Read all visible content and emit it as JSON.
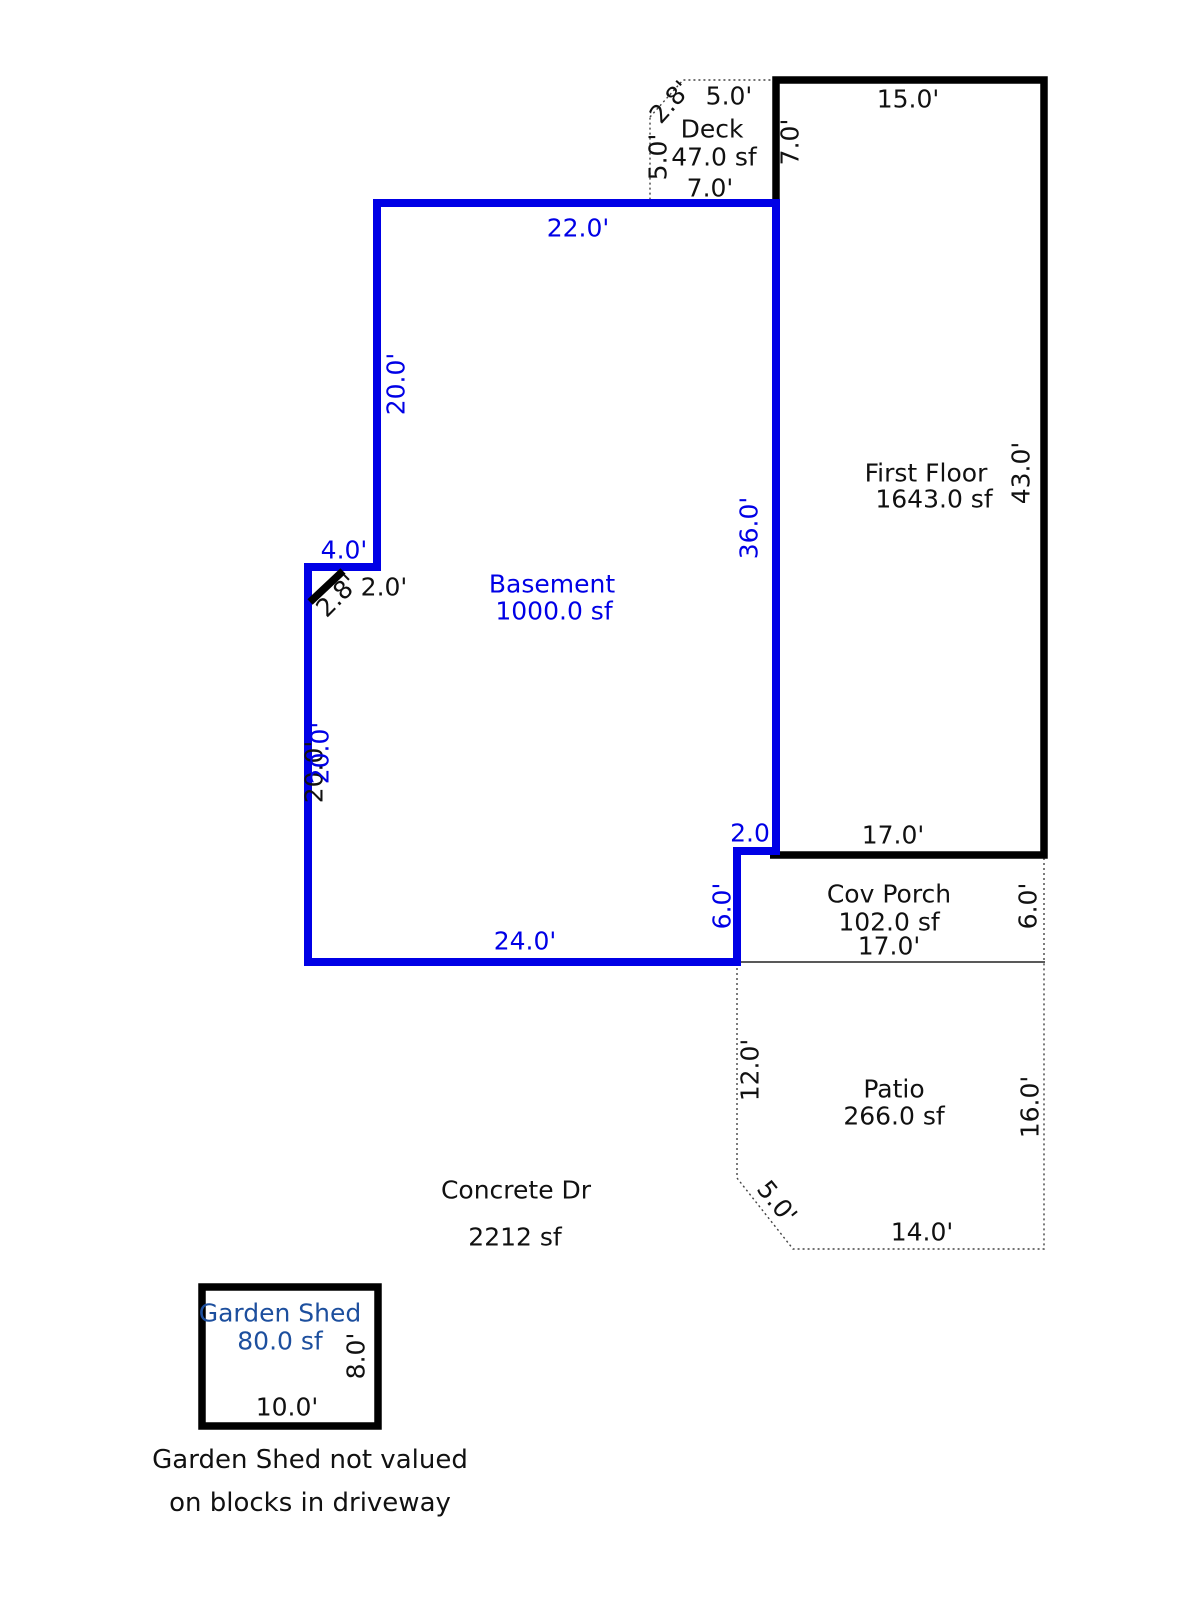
{
  "sketch_title": "Property sketch / floor plan",
  "colors": {
    "outline_black": "#000000",
    "outline_blue": "#0000e6",
    "label_black": "#111111",
    "label_blue": "#0000e6",
    "shed_label_blue": "#1d4f9e",
    "dotted_gray": "#444444",
    "background": "#ffffff"
  },
  "deck": {
    "label": "Deck",
    "area": "47.0 sf",
    "dim_bevel": "2.8'",
    "dim_top": "5.0'",
    "dim_left": "5.0'",
    "dim_bottom": "7.0'"
  },
  "first_floor": {
    "label": "First Floor",
    "area": "1643.0 sf",
    "dim_top": "15.0'",
    "dim_upper_left": "7.0'",
    "dim_right": "43.0'",
    "dim_bottom": "17.0'",
    "dim_notch": "2.0'",
    "dim_notch_bevel": "2.8'",
    "dim_lower_left": "20.0'"
  },
  "basement": {
    "label": "Basement",
    "area": "1000.0 sf",
    "dim_top": "22.0'",
    "dim_upper_left": "20.0'",
    "dim_notch": "4.0'",
    "dim_lower_left": "20.0'",
    "dim_right": "36.0'",
    "dim_step_width": "2.0",
    "dim_step_height": "6.0'",
    "dim_bottom": "24.0'"
  },
  "cov_porch": {
    "label": "Cov Porch",
    "area": "102.0 sf",
    "dim_bottom": "17.0'",
    "dim_right": "6.0'"
  },
  "patio": {
    "label": "Patio",
    "area": "266.0 sf",
    "dim_left": "12.0'",
    "dim_bevel": "5.0'",
    "dim_bottom": "14.0'",
    "dim_right": "16.0'"
  },
  "concrete_drive": {
    "label": "Concrete Dr",
    "area": "2212 sf"
  },
  "garden_shed": {
    "label": "Garden Shed",
    "area": "80.0 sf",
    "dim_right": "8.0'",
    "dim_bottom": "10.0'"
  },
  "notes": {
    "line1": "Garden Shed not valued",
    "line2": "on blocks in driveway"
  }
}
